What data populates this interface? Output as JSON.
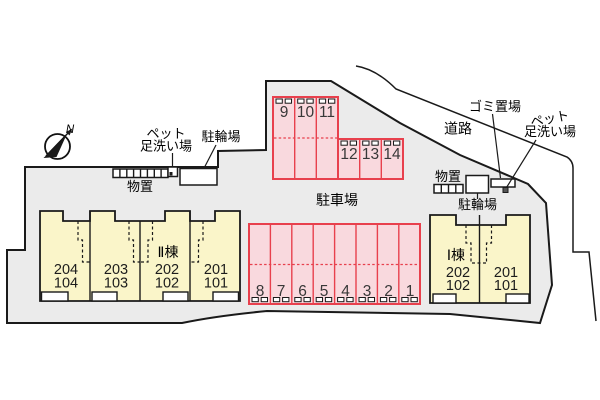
{
  "compass": {
    "north_label": "N"
  },
  "facilities": {
    "storage_left": "物置",
    "bicycle_left": "駐輪場",
    "pet_wash_left": [
      "ペット",
      "足洗い場"
    ],
    "road": "道路",
    "garbage": "ゴミ置場",
    "pet_wash_right": [
      "ペット",
      "足洗い場"
    ],
    "storage_right": "物置",
    "bicycle_right": "駐輪場"
  },
  "parking": {
    "area_label": "駐車場",
    "blocks": {
      "upper": {
        "spaces": [
          "9",
          "10",
          "11"
        ]
      },
      "middle": {
        "spaces": [
          "12",
          "13",
          "14"
        ]
      },
      "lower": {
        "spaces": [
          "8",
          "7",
          "6",
          "5",
          "4",
          "3",
          "2",
          "1"
        ]
      }
    }
  },
  "buildings": {
    "building_2": {
      "name": "Ⅱ棟",
      "units": [
        {
          "upper": "204",
          "lower": "104"
        },
        {
          "upper": "203",
          "lower": "103"
        },
        {
          "upper": "202",
          "lower": "102"
        },
        {
          "upper": "201",
          "lower": "101"
        }
      ]
    },
    "building_1": {
      "name": "Ⅰ棟",
      "units": [
        {
          "upper": "202",
          "lower": "102"
        },
        {
          "upper": "201",
          "lower": "101"
        }
      ]
    }
  },
  "colors": {
    "site_fill": "#ebebeb",
    "parking_fill": "#f9d9de",
    "parking_stroke": "#e8404d",
    "building_fill": "#faf5c9",
    "outline": "#1a1a1a"
  }
}
